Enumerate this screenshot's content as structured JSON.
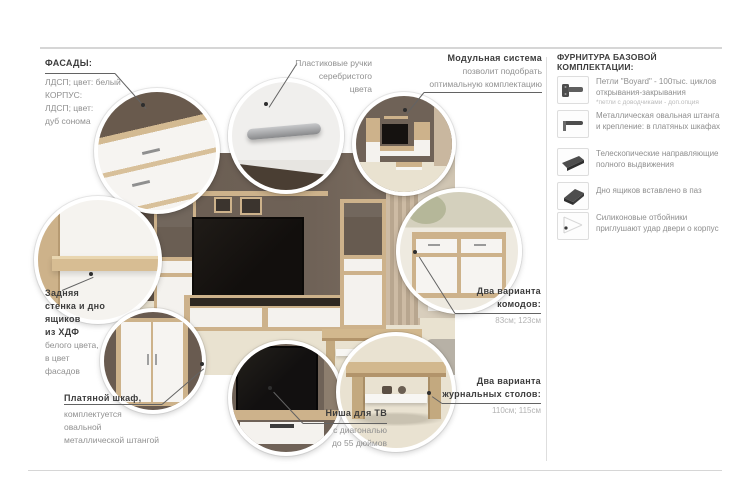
{
  "callouts": {
    "facades": {
      "title": "ФАСАДЫ:",
      "line1": "ЛДСП; цвет: белый",
      "line2": "КОРПУС:",
      "line3": "ЛДСП; цвет:",
      "line4": "дуб сонома"
    },
    "handles": {
      "line1": "Пластиковые ручки",
      "line2": "серебристого",
      "line3": "цвета"
    },
    "modular": {
      "title": "Модульная система",
      "line1": "позволит подобрать",
      "line2": "оптимальную комплектацию"
    },
    "back_panel": {
      "bold1": "Задняя",
      "bold2": "стенка и дно",
      "bold3": "ящиков",
      "bold4": "из ХДФ",
      "line1": "белого цвета,",
      "line2": "в цвет",
      "line3": "фасадов"
    },
    "wardrobe": {
      "title": "Платяной шкаф,",
      "line1": "комплектуется",
      "line2": "овальной",
      "line3": "металлической штангой"
    },
    "tv_niche": {
      "title": "Ниша для ТВ",
      "line1": "с диагональю",
      "line2": "до 55 дюймов"
    },
    "commodes": {
      "bold1": "Два варианта",
      "bold2": "комодов:",
      "value": "83см; 123см"
    },
    "coffee_tables": {
      "bold1": "Два варианта",
      "bold2": "журнальных столов:",
      "value": "110см; 115см"
    }
  },
  "hardware": {
    "title": "ФУРНИТУРА БАЗОВОЙ КОМПЛЕКТАЦИИ:",
    "items": [
      {
        "icon": "hinge-icon",
        "text": "Петли \"Boyard\" - 100тыс. циклов открывания-закрывания",
        "note": "*петли с доводчиками - доп.опция"
      },
      {
        "icon": "oval-rod-icon",
        "text": "Металлическая овальная штанга и крепление: в платяных шкафах"
      },
      {
        "icon": "telescopic-rail-icon",
        "text": "Телескопические направляющие полного выдвижения"
      },
      {
        "icon": "drawer-bottom-icon",
        "text": "Дно ящиков вставлено в паз"
      },
      {
        "icon": "silicone-bumper-icon",
        "text": "Силиконовые отбойники приглушают удар двери о корпус"
      }
    ]
  },
  "colors": {
    "wood": "#cdb28b",
    "wall": "#6f6257",
    "carpet": "#e9e2d1",
    "text_dark": "#3c3c3c",
    "text_gray": "#909090"
  }
}
